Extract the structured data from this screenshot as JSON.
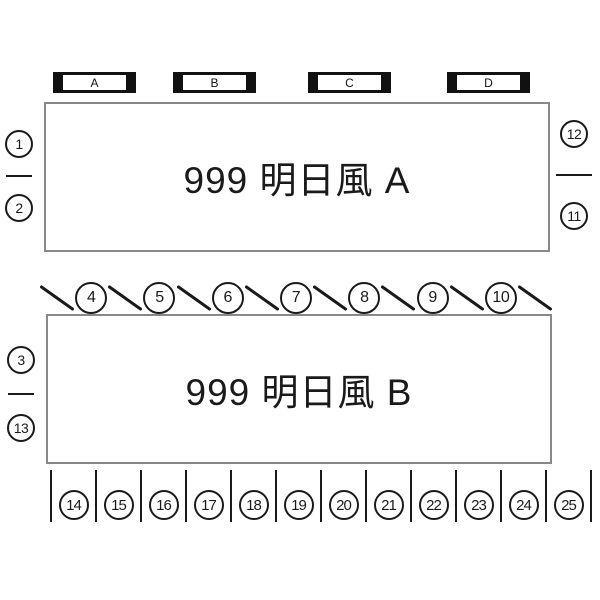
{
  "diagram": {
    "section_labels": [
      "A",
      "B",
      "C",
      "D"
    ],
    "blocks": {
      "a": {
        "title": "999 明日風 A"
      },
      "b": {
        "title": "999 明日風 B"
      }
    },
    "side_markers": {
      "left_a": {
        "top": "1",
        "bottom": "2"
      },
      "right_a": {
        "top": "12",
        "bottom": "11"
      },
      "left_b": {
        "top": "3",
        "bottom": "13"
      }
    },
    "angled_spots": [
      "4",
      "5",
      "6",
      "7",
      "8",
      "9",
      "10"
    ],
    "bottom_spots": [
      "14",
      "15",
      "16",
      "17",
      "18",
      "19",
      "20",
      "21",
      "22",
      "23",
      "24",
      "25"
    ],
    "colors": {
      "ink": "#1a1a1a",
      "block_border": "#888888"
    }
  }
}
